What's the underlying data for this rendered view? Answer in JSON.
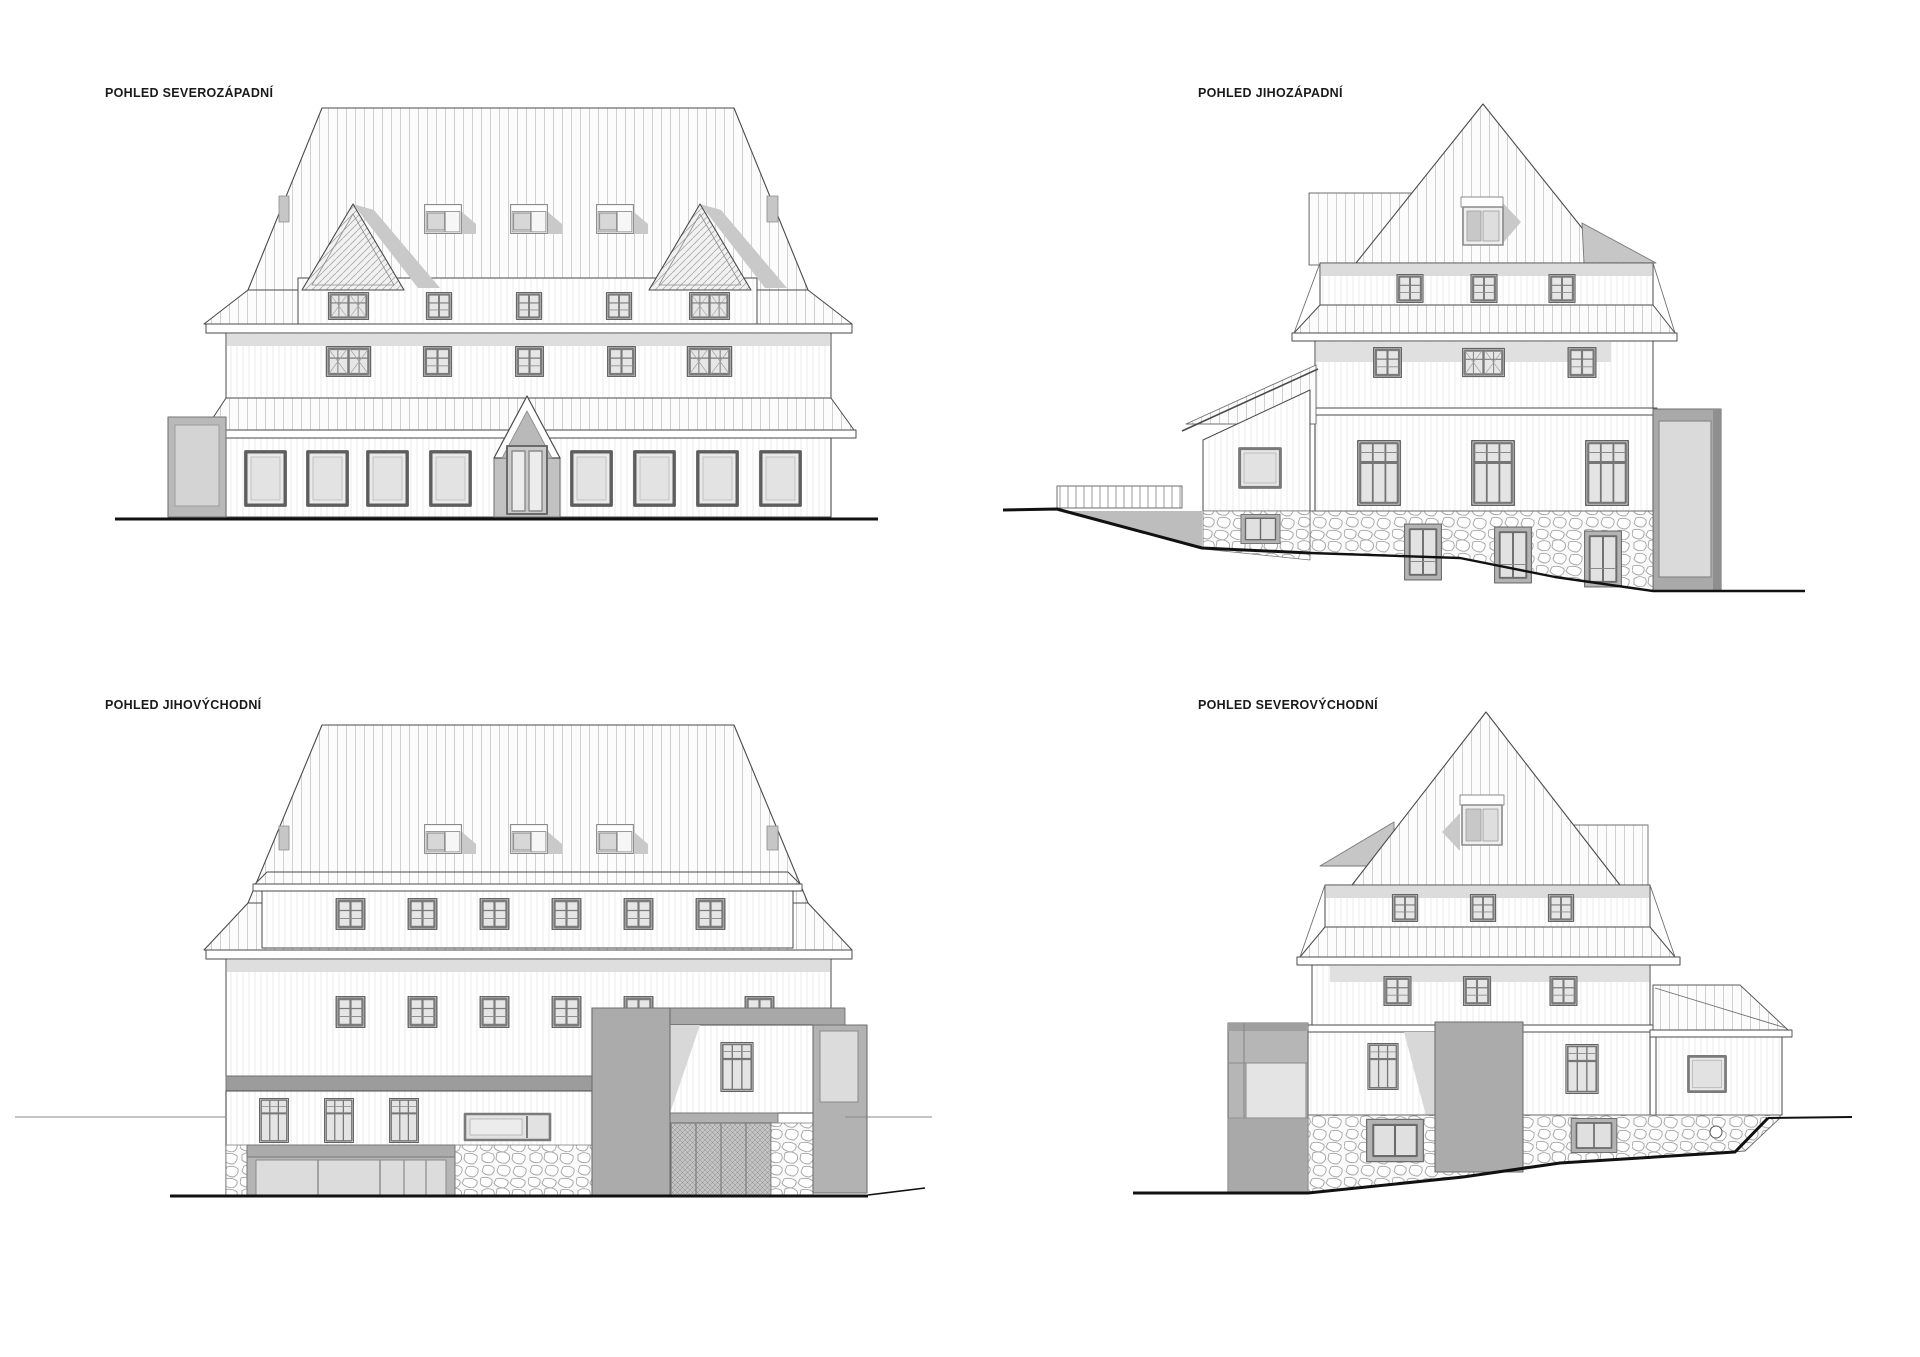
{
  "sheet": {
    "background": "#ffffff",
    "width_px": 1920,
    "height_px": 1357
  },
  "drawing": {
    "type": "architectural-elevations",
    "views": [
      {
        "id": "northwest",
        "label": "POHLED SEVEROZÁPADNÍ",
        "position": "top-left",
        "ground": "flat",
        "roof_dormer_windows": 3,
        "triangular_dormers": 2,
        "attic_windows": 5,
        "middle_windows": 5,
        "ground_windows": 8,
        "entrance": "central gabled portal with double glass door",
        "side_annex": "left grey annex"
      },
      {
        "id": "southwest",
        "label": "POHLED JIHOZÁPADNÍ",
        "position": "top-right",
        "ground": "slopes down to the right",
        "spire_dormer_windows": 1,
        "attic_windows": 3,
        "middle_windows": 3,
        "ground_windows": 3,
        "basement_windows": 4,
        "side_annex": "left single-storey annex with railing",
        "glazed_bay": "right full-height grey glazed bay"
      },
      {
        "id": "southeast",
        "label": "POHLED JIHOVÝCHODNÍ",
        "position": "bottom-left",
        "ground": "flat",
        "roof_dormer_windows": 3,
        "shed_dormer_windows": 6,
        "middle_windows": 6,
        "ground_windows": 4,
        "ribbon_windows": 1,
        "garage_doors": 2,
        "glazed_bay": "right grey glazed bay"
      },
      {
        "id": "northeast",
        "label": "POHLED SEVEROVÝCHODNÍ",
        "position": "bottom-right",
        "ground": "slopes up to the right",
        "spire_dormer_windows": 1,
        "attic_windows": 3,
        "middle_windows": 3,
        "ground_windows": 2,
        "basement_windows": 2,
        "side_annex": "right single-storey annex with shed roof",
        "glazed_bay": "left grey glazed bay"
      }
    ],
    "palette": {
      "paper": "#ffffff",
      "line": "#3f3f3f",
      "ground_line": "#111111",
      "roof_stripe": "#cdcdcd",
      "shadow_band": "#dedede",
      "gray_light": "#d4d4d4",
      "gray_mid": "#b3b3b3",
      "gray_dark": "#9c9c9c",
      "glass": "#e8e8e8",
      "window_frame": "#6e6e6e"
    }
  }
}
